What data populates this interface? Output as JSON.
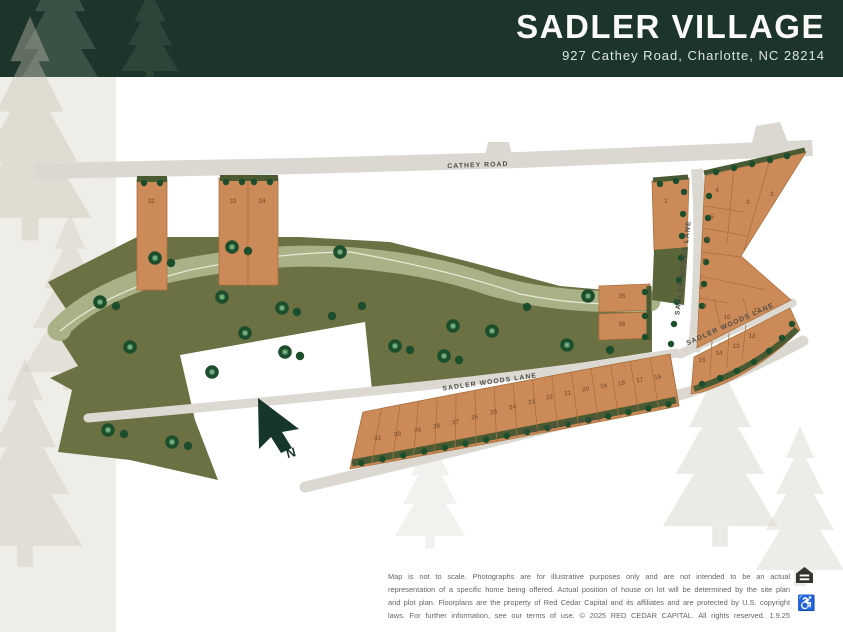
{
  "header": {
    "title": "SADLER VILLAGE",
    "address": "927 Cathey Road,  Charlotte, NC 28214"
  },
  "map": {
    "road_labels": {
      "cathey": "CATHEY ROAD",
      "sadler_woods_west": "SADLER WOODS LANE",
      "sadler_woods_vertical": "SADLER WOODS LANE",
      "sadler_woods_diagonal": "SADLER WOODS LANE",
      "tom_sadler": "TOM SADLER ROAD"
    },
    "north_arrow_label": "N",
    "lots": [
      {
        "n": "1",
        "x": 666,
        "y": 203
      },
      {
        "n": "2",
        "x": 772,
        "y": 196
      },
      {
        "n": "3",
        "x": 748,
        "y": 204
      },
      {
        "n": "4",
        "x": 717,
        "y": 192
      },
      {
        "n": "5",
        "x": 712,
        "y": 219
      },
      {
        "n": "6",
        "x": 708,
        "y": 241
      },
      {
        "n": "7",
        "x": 704,
        "y": 263
      },
      {
        "n": "8",
        "x": 701,
        "y": 289
      },
      {
        "n": "9",
        "x": 705,
        "y": 308
      },
      {
        "n": "10",
        "x": 727,
        "y": 319
      },
      {
        "n": "11",
        "x": 757,
        "y": 312
      },
      {
        "n": "12",
        "x": 752,
        "y": 338
      },
      {
        "n": "13",
        "x": 736,
        "y": 348
      },
      {
        "n": "14",
        "x": 719,
        "y": 355
      },
      {
        "n": "15",
        "x": 702,
        "y": 362
      },
      {
        "n": "16",
        "x": 658,
        "y": 379,
        "r": -10
      },
      {
        "n": "17",
        "x": 640,
        "y": 382,
        "r": -10
      },
      {
        "n": "18",
        "x": 622,
        "y": 385,
        "r": -10
      },
      {
        "n": "19",
        "x": 604,
        "y": 388,
        "r": -10
      },
      {
        "n": "20",
        "x": 586,
        "y": 391,
        "r": -10
      },
      {
        "n": "21",
        "x": 568,
        "y": 395,
        "r": -10
      },
      {
        "n": "22",
        "x": 550,
        "y": 399,
        "r": -10
      },
      {
        "n": "23",
        "x": 532,
        "y": 404,
        "r": -10
      },
      {
        "n": "24",
        "x": 513,
        "y": 409,
        "r": -10
      },
      {
        "n": "25",
        "x": 494,
        "y": 414,
        "r": -10
      },
      {
        "n": "26",
        "x": 475,
        "y": 419,
        "r": -10
      },
      {
        "n": "27",
        "x": 456,
        "y": 424,
        "r": -10
      },
      {
        "n": "28",
        "x": 437,
        "y": 428,
        "r": -10
      },
      {
        "n": "29",
        "x": 418,
        "y": 432,
        "r": -10
      },
      {
        "n": "30",
        "x": 398,
        "y": 436,
        "r": -10
      },
      {
        "n": "31",
        "x": 378,
        "y": 440,
        "r": -10
      },
      {
        "n": "32",
        "x": 151,
        "y": 203
      },
      {
        "n": "33",
        "x": 233,
        "y": 203
      },
      {
        "n": "34",
        "x": 262,
        "y": 203
      },
      {
        "n": "35",
        "x": 622,
        "y": 298
      },
      {
        "n": "36",
        "x": 622,
        "y": 326
      }
    ],
    "trees": [
      [
        155,
        258,
        "d"
      ],
      [
        171,
        263,
        "p"
      ],
      [
        232,
        247,
        "d"
      ],
      [
        248,
        251,
        "p"
      ],
      [
        340,
        252,
        "d"
      ],
      [
        100,
        302,
        "d"
      ],
      [
        116,
        306,
        "p"
      ],
      [
        222,
        297,
        "d"
      ],
      [
        282,
        308,
        "d"
      ],
      [
        297,
        312,
        "p"
      ],
      [
        130,
        347,
        "d"
      ],
      [
        245,
        333,
        "d"
      ],
      [
        285,
        352,
        "d"
      ],
      [
        300,
        356,
        "p"
      ],
      [
        212,
        372,
        "d"
      ],
      [
        108,
        430,
        "d"
      ],
      [
        124,
        434,
        "p"
      ],
      [
        172,
        442,
        "d"
      ],
      [
        188,
        446,
        "p"
      ],
      [
        332,
        316,
        "p"
      ],
      [
        362,
        306,
        "p"
      ],
      [
        395,
        346,
        "d"
      ],
      [
        410,
        350,
        "p"
      ],
      [
        453,
        326,
        "d"
      ],
      [
        444,
        356,
        "d"
      ],
      [
        459,
        360,
        "p"
      ],
      [
        492,
        331,
        "d"
      ],
      [
        527,
        307,
        "p"
      ],
      [
        567,
        345,
        "d"
      ],
      [
        610,
        350,
        "p"
      ],
      [
        588,
        296,
        "d"
      ]
    ],
    "frontage_dots": [
      [
        684,
        192
      ],
      [
        683,
        214
      ],
      [
        682,
        236
      ],
      [
        681,
        258
      ],
      [
        679,
        280
      ],
      [
        677,
        302
      ],
      [
        674,
        324
      ],
      [
        671,
        344
      ],
      [
        709,
        196
      ],
      [
        708,
        218
      ],
      [
        707,
        240
      ],
      [
        706,
        262
      ],
      [
        704,
        284
      ],
      [
        702,
        306
      ],
      [
        716,
        172
      ],
      [
        734,
        168
      ],
      [
        752,
        164
      ],
      [
        770,
        160
      ],
      [
        787,
        156
      ],
      [
        702,
        384
      ],
      [
        720,
        378
      ],
      [
        737,
        371
      ],
      [
        754,
        362
      ],
      [
        769,
        351
      ],
      [
        782,
        338
      ],
      [
        792,
        324
      ],
      [
        660,
        184
      ],
      [
        676,
        181
      ],
      [
        144,
        183
      ],
      [
        160,
        183
      ],
      [
        226,
        182
      ],
      [
        242,
        182
      ],
      [
        254,
        182
      ],
      [
        270,
        182
      ],
      [
        645,
        292
      ],
      [
        645,
        316
      ],
      [
        645,
        337
      ]
    ]
  },
  "footer": {
    "disclaimer_lines": [
      "Map is not to scale. Photographs are for illustrative purposes only and are not intended to be an actual",
      "representation of a specific home being offered. Actual position of house on lot will be determined by the site plan",
      "and plot plan. Floorplans are the property of Red Cedar Capital and its affiliates and are protected by U.S. copyright",
      "laws. For further information, see our terms of use. © 2025 RED CEDAR CAPITAL. All rights reserved. 1.9.25"
    ],
    "accessibility_symbol": "♿"
  },
  "colors": {
    "header_bg": "#1d342a",
    "lot_fill": "#cd8a59",
    "open_space": "#6c7144",
    "creek": "#a9b286",
    "road": "#dad8d1",
    "tree": "#1c4e2b"
  }
}
